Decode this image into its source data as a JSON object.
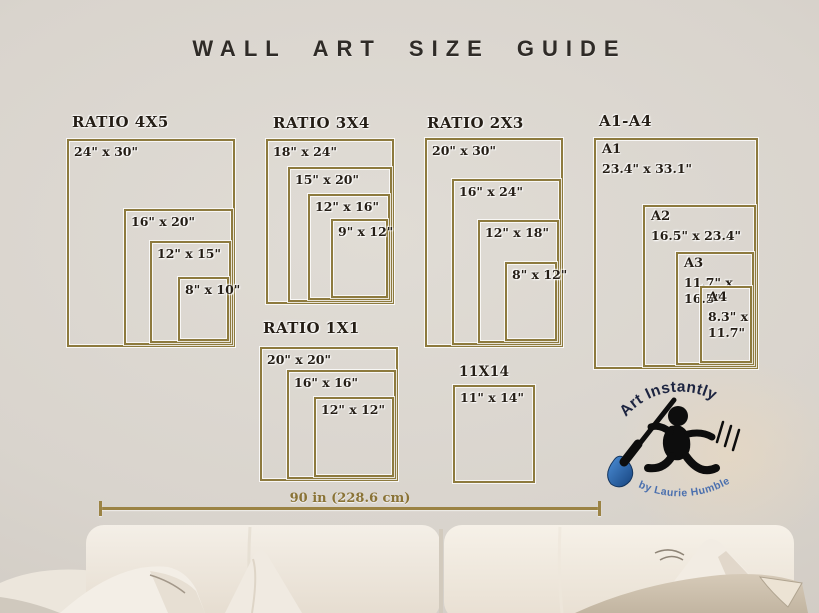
{
  "title": "WALL ART SIZE GUIDE",
  "groups": [
    {
      "label": "RATIO 4X5",
      "boxes": [
        {
          "label": "24\" x 30\""
        },
        {
          "label": "16\" x 20\""
        },
        {
          "label": "12\" x 15\""
        },
        {
          "label": "8\" x 10\""
        }
      ]
    },
    {
      "label": "RATIO 3X4",
      "boxes": [
        {
          "label": "18\" x 24\""
        },
        {
          "label": "15\" x 20\""
        },
        {
          "label": "12\" x 16\""
        },
        {
          "label": "9\" x 12\""
        }
      ]
    },
    {
      "label": "RATIO 2X3",
      "boxes": [
        {
          "label": "20\" x 30\""
        },
        {
          "label": "16\" x 24\""
        },
        {
          "label": "12\" x 18\""
        },
        {
          "label": "8\" x 12\""
        }
      ]
    },
    {
      "label": "A1-A4",
      "boxes": [
        {
          "name": "A1",
          "dims": "23.4\" x 33.1\""
        },
        {
          "name": "A2",
          "dims": "16.5\" x 23.4\""
        },
        {
          "name": "A3",
          "dims": "11.7\" x 16.5\""
        },
        {
          "name": "A4",
          "dims": "8.3\" x\n11.7\""
        }
      ]
    },
    {
      "label": "RATIO 1X1",
      "boxes": [
        {
          "label": "20\" x 20\""
        },
        {
          "label": "16\" x 16\""
        },
        {
          "label": "12\" x 12\""
        }
      ]
    },
    {
      "label": "11X14",
      "boxes": [
        {
          "label": "11\" x 14\""
        }
      ]
    }
  ],
  "measurement": {
    "label": "90 in (228.6 cm)"
  },
  "logo": {
    "title": "Art Instantly",
    "byline": "by Laurie Humble"
  },
  "colors": {
    "frame": "#8d7a3e",
    "gold": "#9b8344",
    "gold-dark": "#8a7336",
    "ink": "#241d15",
    "title": "#2f2b27",
    "navy": "#1c2440",
    "blue": "#4a6fae",
    "wall": "#d9d4cd"
  }
}
